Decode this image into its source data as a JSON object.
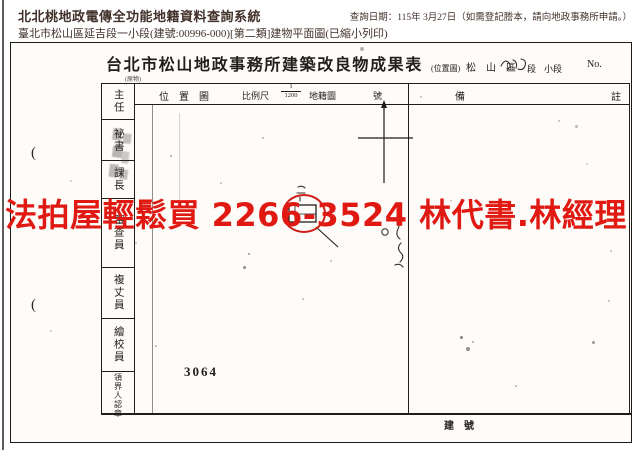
{
  "colors": {
    "header_text": "#41302a",
    "scan_ink": "#221e1a",
    "watermark_red": "#e01913",
    "annotation_red": "#cf1d18"
  },
  "header": {
    "system_title": "北北桃地政電傳全功能地籍資料查詢系統",
    "query_date": "查詢日期：115年 3月27日（如需登記謄本，請向地政事務所申請。）",
    "subtitle": "臺北市松山區延吉段一小段(建號:00996-000)[第二類]建物平面圖(已縮小列印)"
  },
  "document": {
    "title": "台北市松山地政事務所建築改良物成果表",
    "title_note": "(原物)",
    "location": {
      "paren_label": "(位置圖)",
      "district": "松　山　區",
      "duan": "段",
      "xiao_duan": "小段",
      "no_label": "No."
    },
    "map_header": {
      "label": "位　置　圖",
      "scale_label": "比例尺",
      "scale_numerator": "1",
      "scale_denominator": "1200",
      "cadastral_label": "地籍圖",
      "number_label": "號"
    },
    "remarks": {
      "left_char": "備",
      "right_char": "註"
    },
    "signature_roles": [
      "主任",
      "祕書",
      "課長",
      "審查員",
      "複丈員",
      "繪校員",
      "領界人認章"
    ],
    "map": {
      "lot_number": "3064"
    },
    "building_no_label": "建　號",
    "margin_mark": "("
  },
  "watermark": {
    "text": "法拍屋輕鬆買 2266-3524 林代書.林經理"
  }
}
